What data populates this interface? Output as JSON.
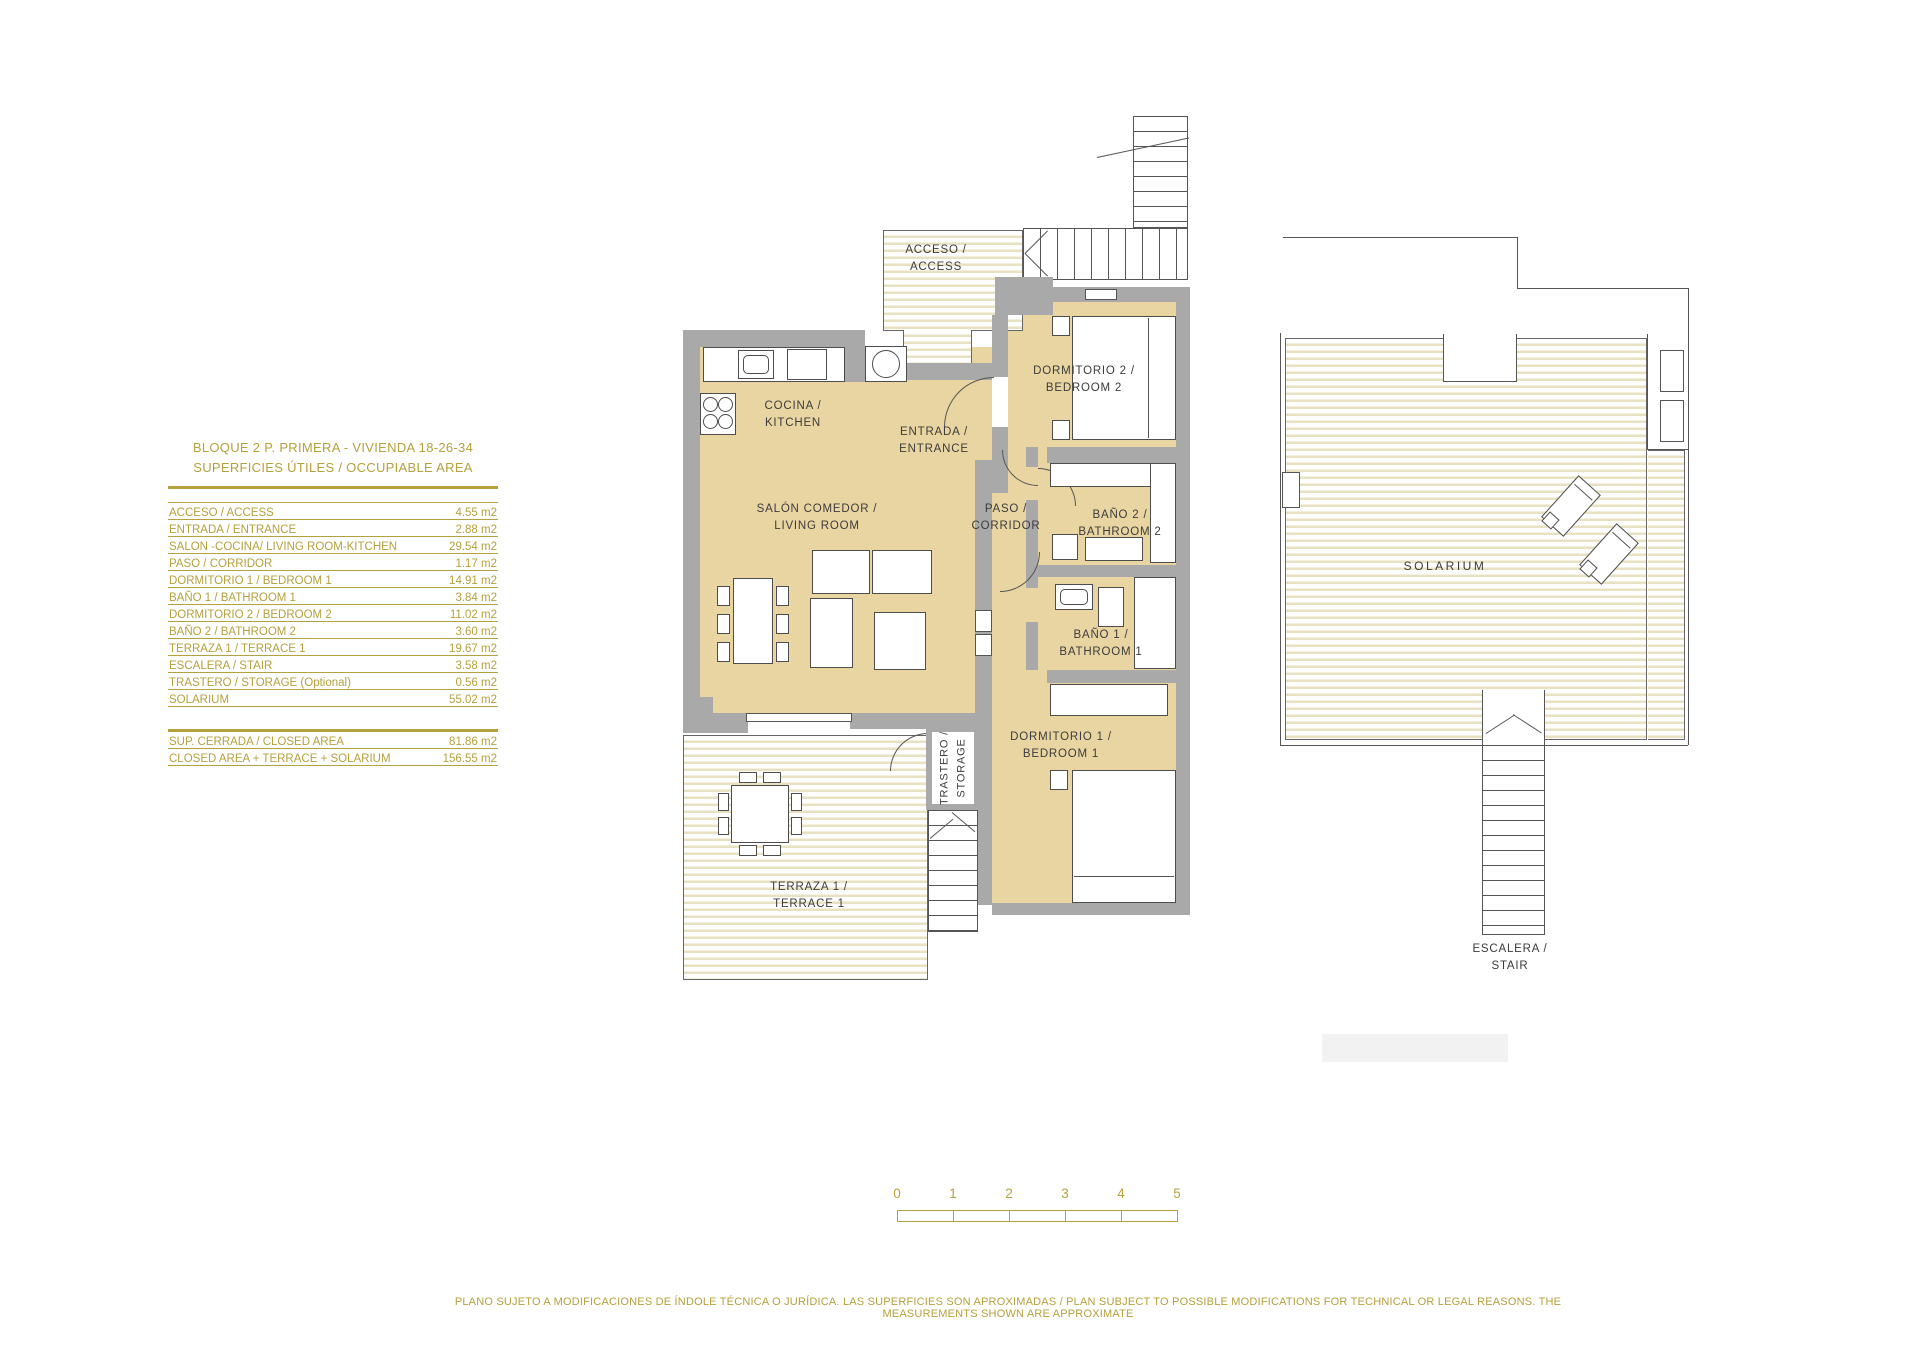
{
  "table": {
    "title_line1": "BLOQUE 2  P. PRIMERA - VIVIENDA 18-26-34",
    "title_line2": "SUPERFICIES ÚTILES / OCCUPIABLE  AREA",
    "rows": [
      {
        "label": "ACCESO / ACCESS",
        "value": "4.55 m2"
      },
      {
        "label": "ENTRADA / ENTRANCE",
        "value": "2.88 m2"
      },
      {
        "label": "SALON -COCINA/ LIVING ROOM-KITCHEN",
        "value": "29.54 m2"
      },
      {
        "label": "PASO / CORRIDOR",
        "value": "1.17 m2"
      },
      {
        "label": "DORMITORIO 1 /  BEDROOM 1",
        "value": "14.91 m2"
      },
      {
        "label": "BAÑO 1 / BATHROOM 1",
        "value": "3.84 m2"
      },
      {
        "label": "DORMITORIO 2 / BEDROOM 2",
        "value": "11.02 m2"
      },
      {
        "label": "BAÑO 2 / BATHROOM 2",
        "value": "3.60 m2"
      },
      {
        "label": "TERRAZA 1 / TERRACE 1",
        "value": "19.67 m2"
      },
      {
        "label": "ESCALERA / STAIR",
        "value": "3.58 m2"
      },
      {
        "label": "TRASTERO / STORAGE (Optional)",
        "value": "0.56 m2"
      },
      {
        "label": "SOLARIUM",
        "value": "55.02 m2"
      }
    ],
    "summary": [
      {
        "label": "SUP. CERRADA / CLOSED AREA",
        "value": "81.86 m2"
      },
      {
        "label": "CLOSED AREA + TERRACE + SOLARIUM",
        "value": "156.55 m2"
      }
    ]
  },
  "plan": {
    "labels": {
      "acceso": "ACCESO /\nACCESS",
      "cocina": "COCINA /\nKITCHEN",
      "entrada": "ENTRADA /\nENTRANCE",
      "dormitorio2": "DORMITORIO 2 /\nBEDROOM 2",
      "paso": "PASO /\nCORRIDOR",
      "bano2": "BAÑO 2 /\nBATHROOM 2",
      "bano1": "BAÑO 1 /\nBATHROOM 1",
      "salon": "SALÓN COMEDOR /\nLIVING ROOM",
      "dormitorio1": "DORMITORIO 1 /\nBEDROOM 1",
      "trastero": "TRASTERO /\nSTORAGE",
      "terraza": "TERRAZA 1 /\nTERRACE 1"
    }
  },
  "solarium_plan": {
    "label": "SOLARIUM",
    "stair_label": "ESCALERA /\nSTAIR"
  },
  "scalebar": {
    "ticks": [
      "0",
      "1",
      "2",
      "3",
      "4",
      "5"
    ]
  },
  "footer": {
    "disclaimer": "PLANO SUJETO A MODIFICACIONES DE ÍNDOLE TÉCNICA O JURÍDICA. LAS SUPERFICIES SON APROXIMADAS / PLAN SUBJECT TO POSSIBLE MODIFICATIONS FOR TECHNICAL OR LEGAL REASONS. THE MEASUREMENTS SHOWN ARE APPROXIMATE"
  },
  "colors": {
    "accent_gold": "#b5a13d",
    "room_fill": "#e9d5a2",
    "wall_gray": "#a9a9a9",
    "line_dark": "#4d4d4d",
    "hatch_tint": "#e9e2c2"
  }
}
